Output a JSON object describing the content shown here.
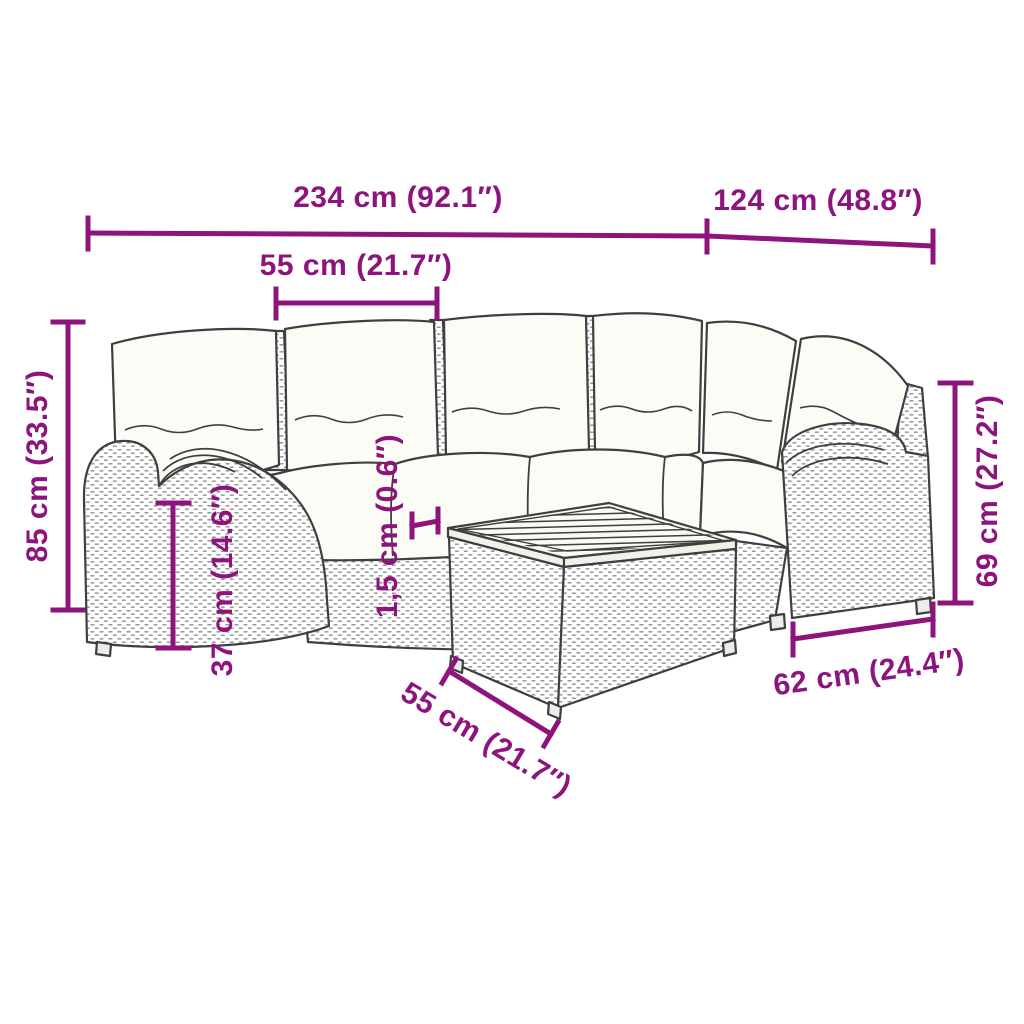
{
  "diagram": {
    "type": "product-dimension-diagram",
    "accent_color": "#8E147D",
    "line_color": "#3F3F3F",
    "cushion_color": "#FCFCF6",
    "background_color": "#FFFFFF",
    "illustration_parts": [
      "left-armrest",
      "right-armrest",
      "back-cushions",
      "seat-cushions",
      "rattan-base",
      "corner-section",
      "coffee-table",
      "wood-slat-tabletop"
    ]
  },
  "annotations": {
    "overall_width": {
      "label": "234 cm (92.1″)"
    },
    "depth": {
      "label": "124 cm (48.8″)"
    },
    "seat_width_top": {
      "label": "55 cm (21.7″)"
    },
    "overall_height": {
      "label": "85 cm (33.5″)"
    },
    "seat_height": {
      "label": "37 cm (14.6″)"
    },
    "tabletop_thickness": {
      "label": "1,5 cm (0.6″)"
    },
    "armrest_height": {
      "label": "69 cm (27.2″)"
    },
    "table_depth": {
      "label": "62 cm (24.4″)"
    },
    "table_width": {
      "label": "55 cm (21.7″)"
    }
  }
}
